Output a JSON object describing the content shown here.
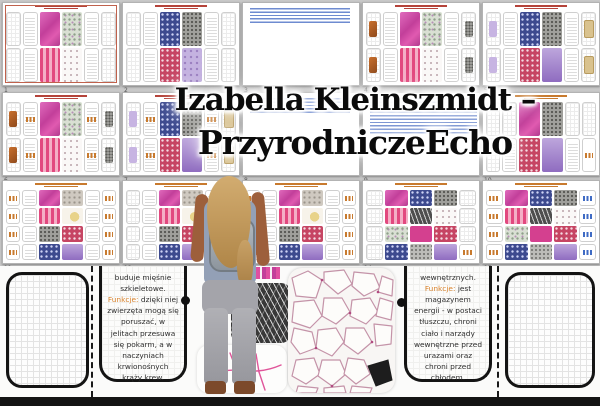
{
  "background": "#c9c9c9",
  "title": {
    "line1": "Izabella Kleinszmidt –",
    "line2": "PrzyrodniczeEcho",
    "text_color": "#0b0b0b",
    "glow_color": "#ffffff"
  },
  "pages": [
    {
      "number": "1",
      "kind": "sheet",
      "accent": "red",
      "bordered": true,
      "tiles": [
        "t-mag",
        "t-pstripe",
        "t-grn",
        "t-wspeck"
      ],
      "chip_left": "",
      "chip_right": "",
      "labels": false
    },
    {
      "number": "2",
      "kind": "sheet",
      "accent": "red",
      "tiles": [
        "t-navy",
        "t-rspeck",
        "t-gspeck",
        "t-lilac"
      ],
      "chip_left": "",
      "chip_right": "",
      "labels": false
    },
    {
      "number": "3",
      "kind": "links",
      "lines": "short"
    },
    {
      "number": "4",
      "kind": "sheet",
      "accent": "red",
      "tiles": [
        "t-mag",
        "t-pstripe",
        "t-grn",
        "t-wspeck"
      ],
      "chip_left": "chip-or",
      "chip_right": "chip-gs",
      "labels": false
    },
    {
      "number": "5",
      "kind": "sheet",
      "accent": "red",
      "tiles": [
        "t-navy",
        "t-rspeck",
        "t-gspeck",
        "t-purp"
      ],
      "chip_left": "chip-pu",
      "chip_right": "chip-tan",
      "labels": false
    },
    {
      "number": "6",
      "kind": "sheet",
      "accent": "red",
      "tiles": [
        "t-mag",
        "t-pstripe",
        "t-grn",
        "t-wspeck"
      ],
      "chip_left": "chip-or",
      "chip_right": "chip-gs",
      "labels": true
    },
    {
      "number": "7",
      "kind": "sheet",
      "accent": "red",
      "tiles": [
        "t-navy",
        "t-rspeck",
        "t-gspeck",
        "t-purp"
      ],
      "chip_left": "chip-pu",
      "chip_right": "chip-tan",
      "labels": true
    },
    {
      "number": "8",
      "kind": "links",
      "lines": "short"
    },
    {
      "number": "9",
      "kind": "links",
      "lines": "tall"
    },
    {
      "number": "10",
      "kind": "card-grid",
      "accent": "orange",
      "tiles": [
        "t-mag",
        "t-gspeck",
        "t-rspeck",
        "t-purp"
      ]
    },
    {
      "number": "11",
      "kind": "label-grid",
      "accent": "orange",
      "left": "lbl",
      "rows": [
        [
          "t-mag",
          "t-gtan"
        ],
        [
          "t-pstripe",
          "t-wyel"
        ],
        [
          "t-gspeck",
          "t-rspeck"
        ],
        [
          "t-navy",
          "t-purp"
        ]
      ]
    },
    {
      "number": "12",
      "kind": "label-grid",
      "accent": "orange",
      "left": "gcard",
      "rows": [
        [
          "t-mag",
          "t-gtan"
        ],
        [
          "t-pstripe",
          "t-wyel"
        ],
        [
          "t-gspeck",
          "t-rspeck"
        ],
        [
          "t-navy",
          "t-purp"
        ]
      ]
    },
    {
      "number": "13",
      "kind": "label-grid",
      "accent": "orange",
      "left": "lbl",
      "rows": [
        [
          "t-mag",
          "t-gtan"
        ],
        [
          "t-pstripe",
          "t-wyel"
        ],
        [
          "t-gspeck",
          "t-rspeck"
        ],
        [
          "t-navy",
          "t-purp"
        ]
      ]
    },
    {
      "number": "14",
      "kind": "micro-grid",
      "accent": "orange",
      "labels": false,
      "rows": [
        [
          "t-mag",
          "t-navy",
          "t-gspeck"
        ],
        [
          "t-pstripe",
          "t-dk",
          "t-wspeck"
        ],
        [
          "t-grn",
          "t-magsolid",
          "t-rspeck"
        ],
        [
          "t-navy",
          "t-gs2",
          "t-purp"
        ]
      ]
    },
    {
      "number": "15",
      "kind": "micro-grid",
      "accent": "orange",
      "labels": true,
      "rows": [
        [
          "t-mag",
          "t-navy",
          "t-gspeck"
        ],
        [
          "t-pstripe",
          "t-dk",
          "t-wspeck"
        ],
        [
          "t-grn",
          "t-magsolid",
          "t-rspeck"
        ],
        [
          "t-navy",
          "t-gs2",
          "t-purp"
        ]
      ]
    }
  ],
  "detail": {
    "left_card": {
      "text_before": "buduje mięśnie szkieletowe.",
      "label": "Funkcje:",
      "text_after": "dzięki niej zwierzęta mogą się poruszać, w jelitach przesuwa się pokarm, a w naczyniach krwionośnych krąży krew."
    },
    "right_card": {
      "text_before": "wewnętrznych.",
      "label": "Funkcje:",
      "text_after": "jest magazynem energii - w postaci tłuszczu, chroni ciało i narządy wewnętrzne przed urazami oraz chroni przed chłodem."
    },
    "funkcje_color": "#d9822b"
  },
  "colors": {
    "thumb_bg": "#ffffff",
    "link_blue": "#6e8bd0",
    "sheet_title_red": "#b5433a",
    "label_orange": "#c87a2e",
    "card_border_black": "#141414",
    "muscle_dark": "#383838",
    "adipose_outline": "#c493a8",
    "nerve_pink": "#e0559a"
  },
  "person": {
    "hair": "#bf9a5e",
    "top": "#93a0b6",
    "sleeves": "#9d5f3b",
    "backpack": "#99a1a9",
    "pants": "#a5a5ab",
    "shoes": "#7c4a2b"
  }
}
